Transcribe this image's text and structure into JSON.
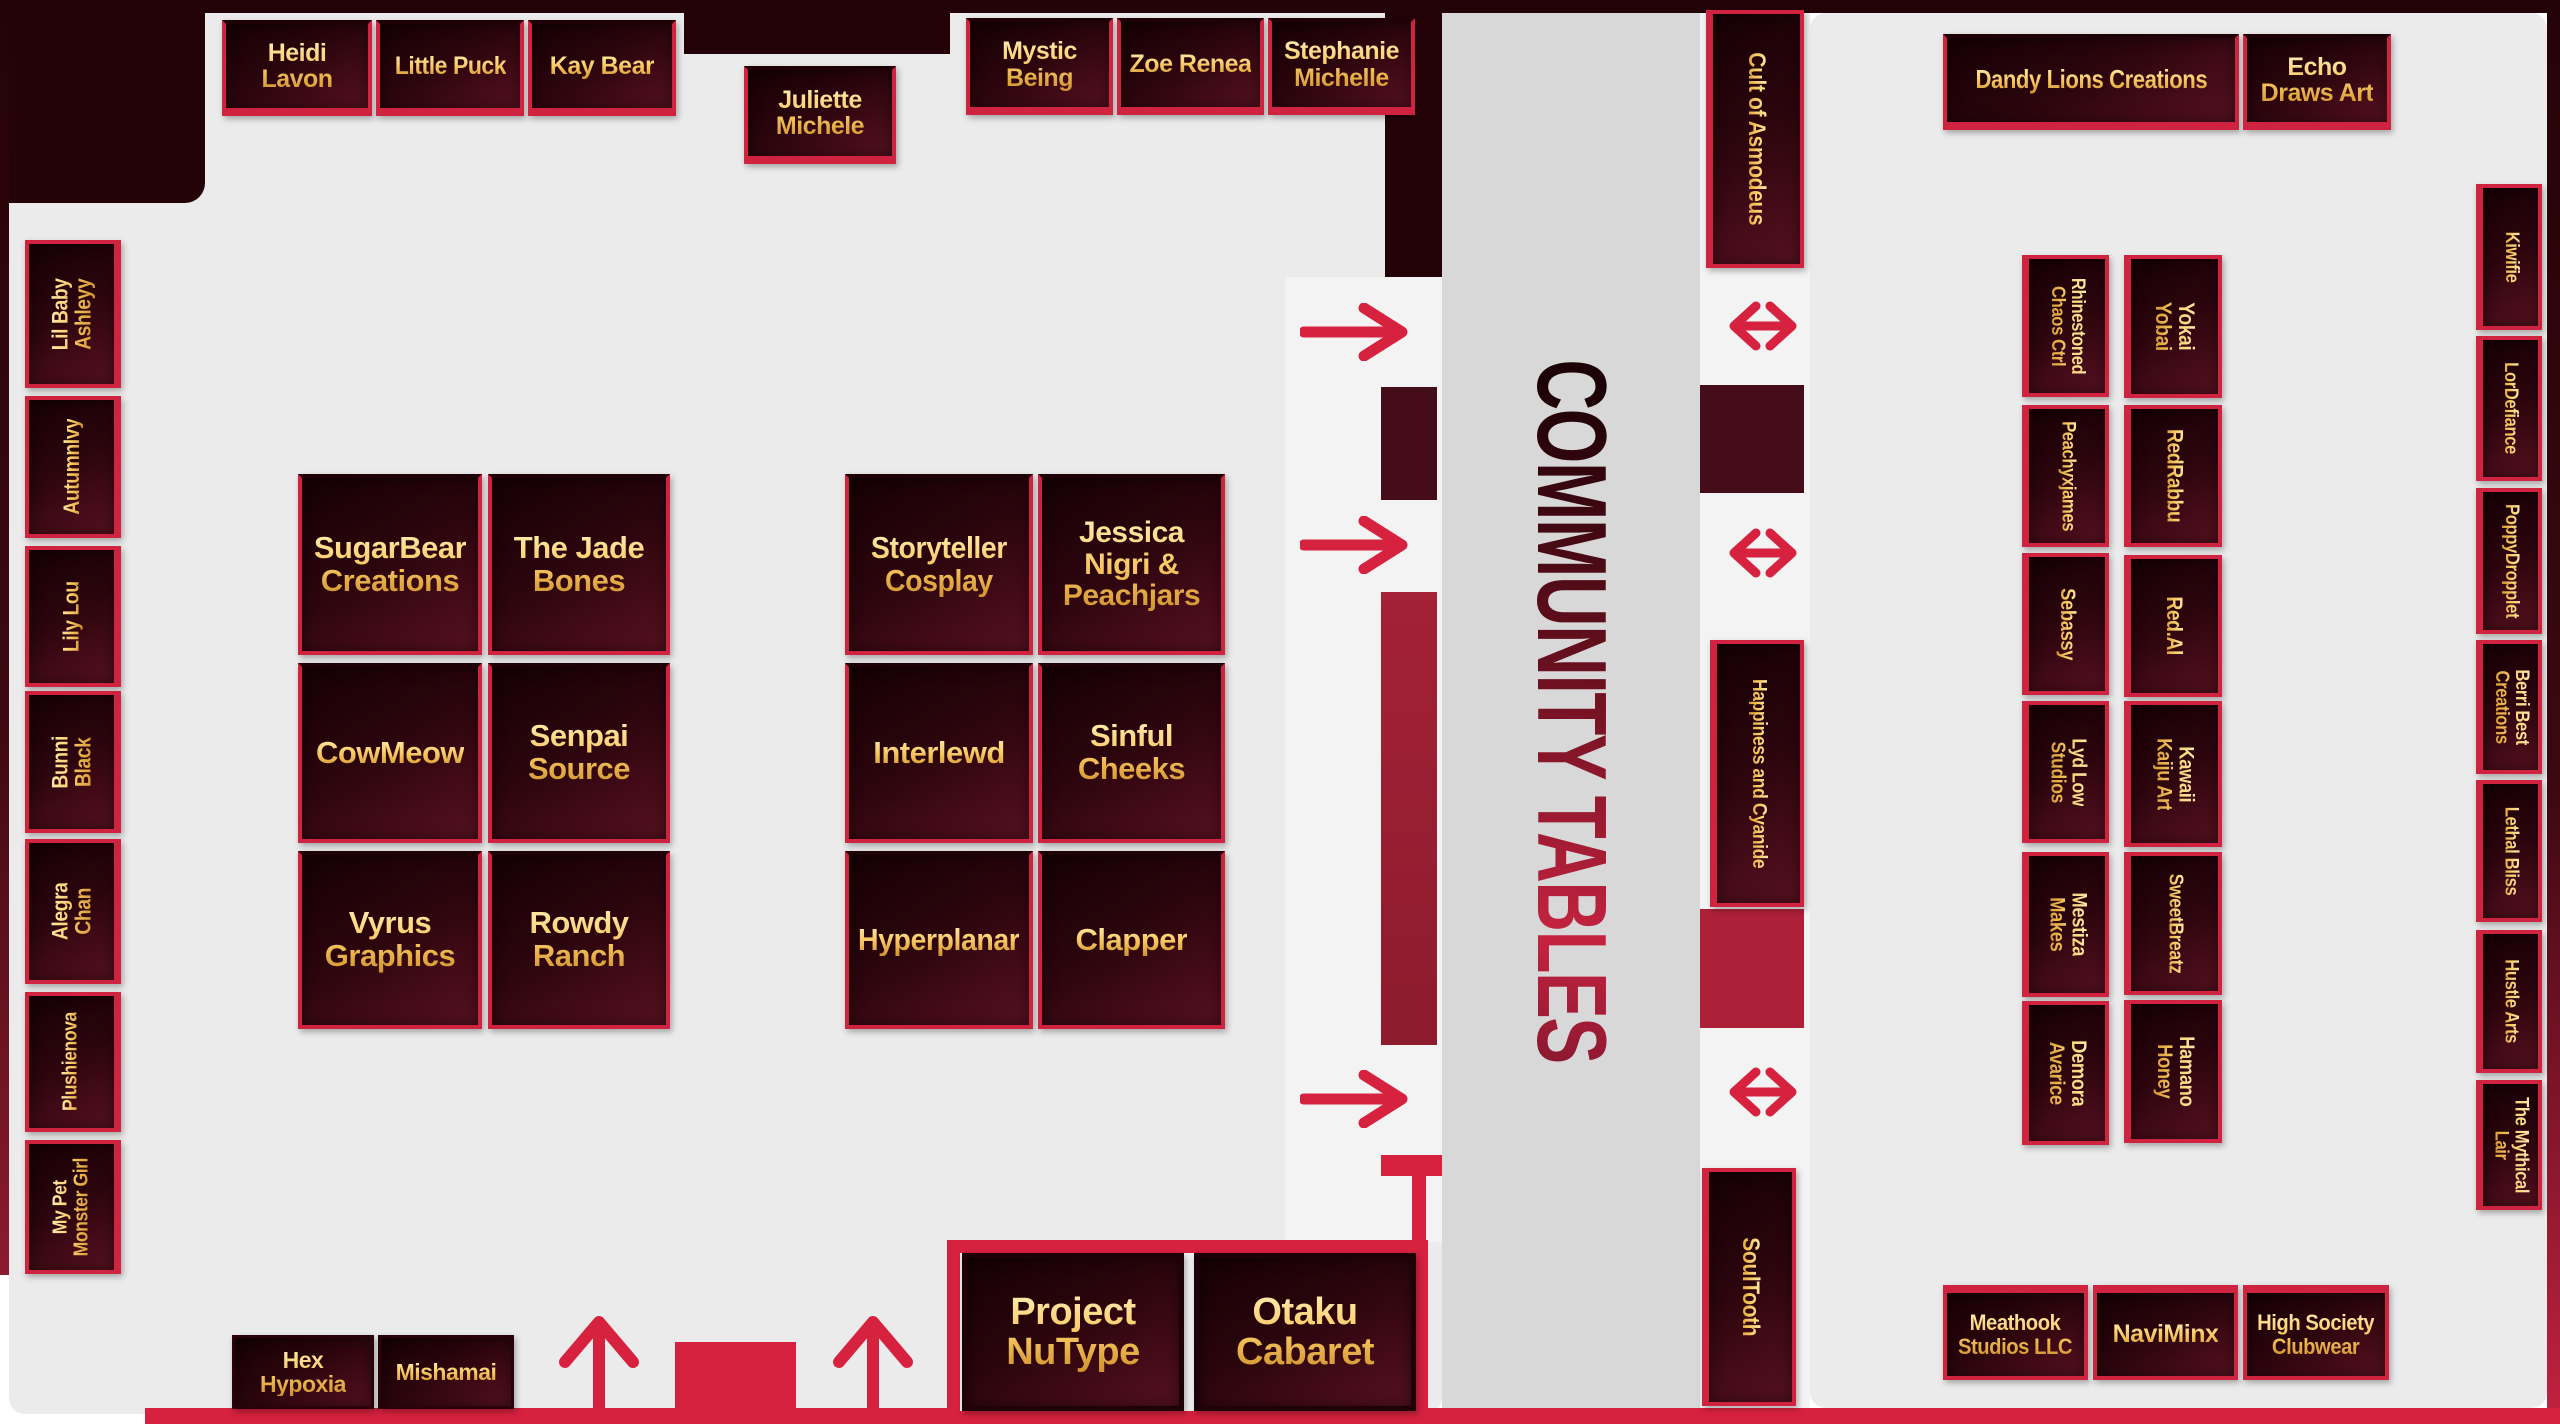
{
  "map_title": "Convention vendor floor map",
  "center": {
    "label": "COMMUNITY TABLES"
  },
  "left_wing": {
    "top_booths": [
      "Heidi\nLavon",
      "Little Puck",
      "Kay Bear"
    ],
    "juliette": "Juliette\nMichele",
    "top_booths_b": [
      "Mystic\nBeing",
      "Zoe Renea",
      "Stephanie\nMichelle"
    ],
    "wall_booths": [
      "Lil Baby\nAshleyy",
      "AutumnIvy",
      "Lily Lou",
      "Bunni\nBlack",
      "Alegra\nChan",
      "Plushienova",
      "My Pet\nMonster Girl"
    ],
    "island_a": [
      "SugarBear\nCreations",
      "The Jade\nBones",
      "CowMeow",
      "Senpai\nSource",
      "Vyrus\nGraphics",
      "Rowdy\nRanch"
    ],
    "island_b": [
      "Storyteller\nCosplay",
      "Jessica\nNigri &\nPeachjars",
      "Interlewd",
      "Sinful\nCheeks",
      "Hyperplanar",
      "Clapper"
    ],
    "bottom_booths": [
      "Hex\nHypoxia",
      "Mishamai"
    ],
    "feature_booths": [
      "Project\nNuType",
      "Otaku\nCabaret"
    ]
  },
  "right_wing": {
    "aisle_booths": [
      "Cult of Asmodeus",
      "Happiness and Cyanide",
      "SoulTooth"
    ],
    "top_booths": [
      "Dandy Lions Creations",
      "Echo\nDraws Art"
    ],
    "island_left": [
      "Rhinestoned\nChaos Ctrl",
      "Peachyxjames",
      "Sebassy",
      "Lyd Low\nStudios",
      "Mestiza\nMakes",
      "Demora\nAvarice"
    ],
    "island_right": [
      "Yokai\nYobai",
      "RedRabbu",
      "Red.Al",
      "Kawaii\nKaiju Art",
      "SweetBreatz",
      "Hamano\nHoney"
    ],
    "wall_booths": [
      "Kiwifie",
      "LorDefiance",
      "PoppyDropplet",
      "Berri Best\nCreations",
      "Lethal Bliss",
      "Hustle Arts",
      "The Mythical\nLair"
    ],
    "bottom_booths": [
      "Meathook\nStudios LLC",
      "NaviMinx",
      "High Society\nClubwear"
    ]
  },
  "icons": {
    "right_arrow": "→",
    "double_arrow": "↔",
    "up_arrow": "↑"
  },
  "colors": {
    "booth_border": "#cf2340",
    "booth_fill_dark": "#160104",
    "accent_red": "#d6213f",
    "gold_text": "#f7c862",
    "room_gray": "#ebebeb",
    "aisle_gray": "#d8d8d8",
    "wall_dark": "#240308"
  }
}
